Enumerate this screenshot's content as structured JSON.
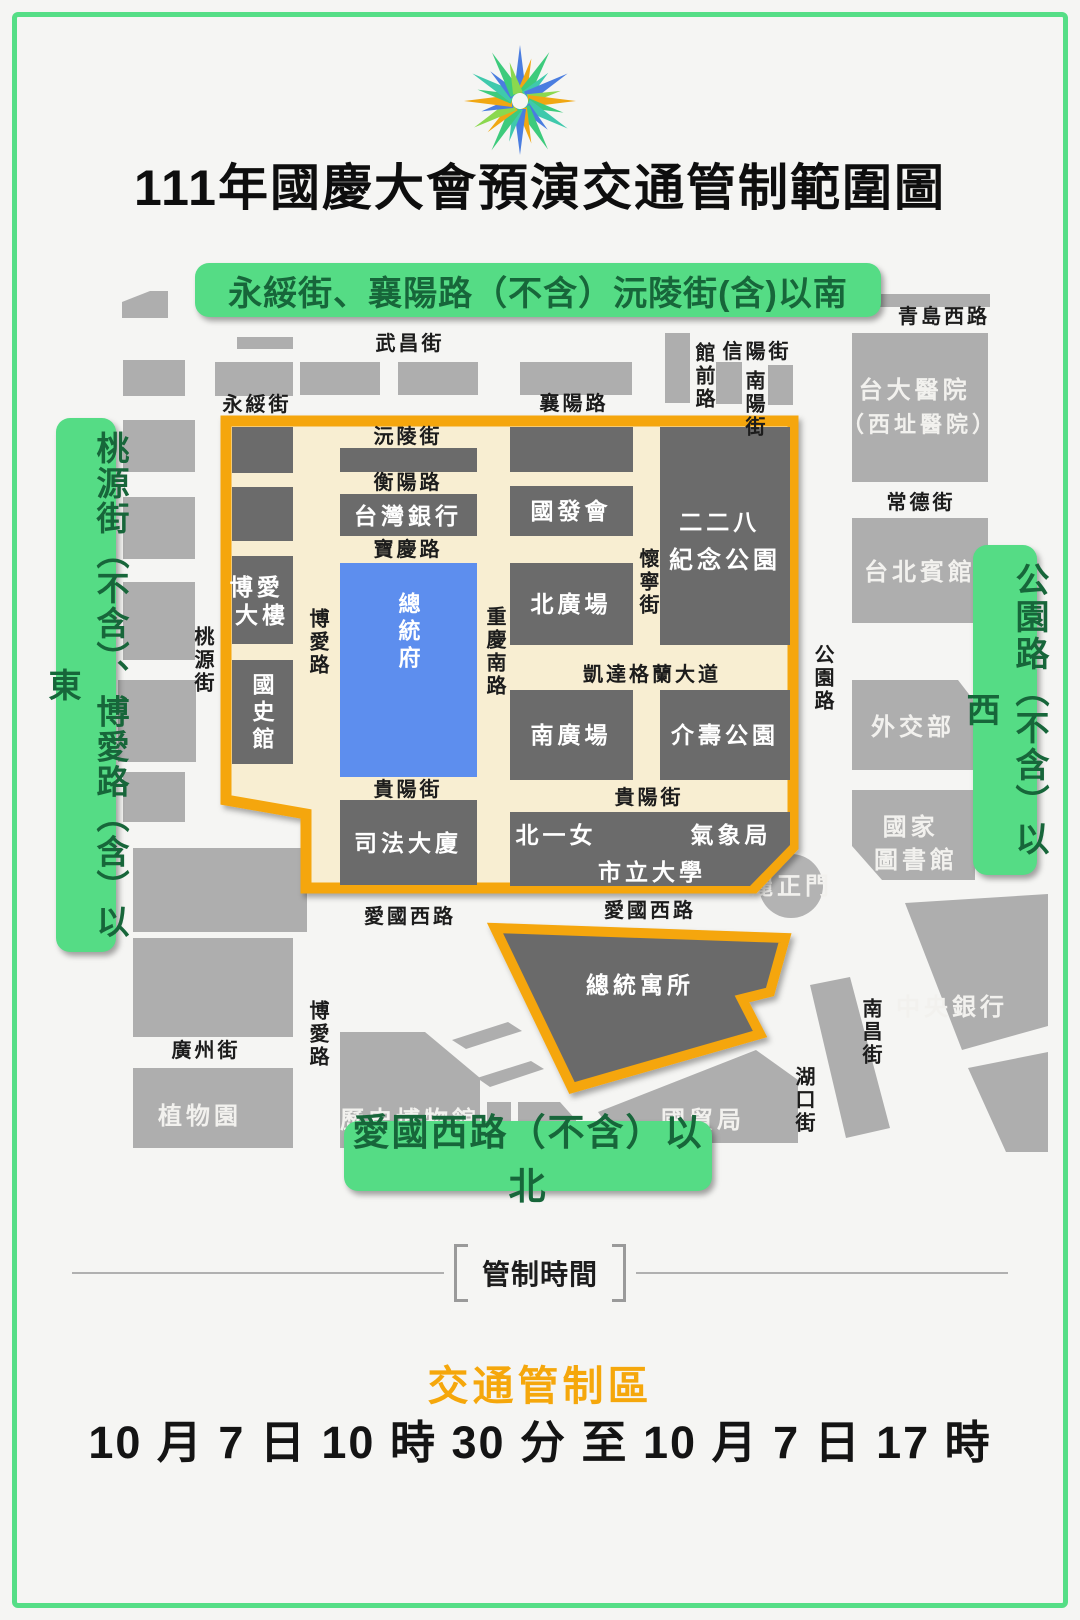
{
  "title": "111年國慶大會預演交通管制範圍圖",
  "banners": {
    "north": "永綏街、襄陽路（不含）沅陵街(含)以南",
    "west": "桃源街（不含）、博愛路（含）以東",
    "east": "公園路（不含）以西",
    "south": "愛國西路（不含）以北"
  },
  "map": {
    "streets": {
      "wuchang": "武昌街",
      "yongsui": "永綏街",
      "xiangyang": "襄陽路",
      "qingdao_w": "青島西路",
      "guanqian": "館前路",
      "xinyang": "信陽街",
      "nanyang": "南陽街",
      "changde": "常德街",
      "gongyuan": "公園路",
      "taoyuan": "桃源街",
      "yuanling": "沅陵街",
      "hengyang": "衡陽路",
      "baoqing": "寶慶路",
      "boai": "博愛路",
      "chongqing_s": "重慶南路",
      "huaining": "懷寧街",
      "ketagalan": "凱達格蘭大道",
      "guiyang": "貴陽街",
      "aiguo_xi": "愛國西路",
      "guangzhou": "廣州街",
      "nanchang": "南昌街",
      "hukou": "湖口街"
    },
    "places": {
      "ntu_hospital": "台大醫院",
      "ntu_hospital_sub": "（西址醫院）",
      "taipei_guest_house": "台北賓館",
      "mofa": "外交部",
      "ncl_line1": "國家",
      "ncl_line2": "圖書館",
      "lizhengmen": "麗正門",
      "central_bank": "中央銀行",
      "trade_bureau": "國貿局",
      "history_museum": "歷史博物館",
      "botanical_garden": "植物園",
      "bank_of_taiwan": "台灣銀行",
      "ndc": "國發會",
      "park228_line1": "二二八",
      "park228_line2": "紀念公園",
      "boai_bldg_line1": "博愛",
      "boai_bldg_line2": "大樓",
      "academia_historica": "國史館",
      "presidential_office": "總統府",
      "north_plaza": "北廣場",
      "south_plaza": "南廣場",
      "jieshou_park": "介壽公園",
      "judicial_building": "司法大廈",
      "first_girls_school": "北一女",
      "weather_bureau": "氣象局",
      "city_university": "市立大學",
      "presidential_residence": "總統寓所"
    }
  },
  "footer": {
    "section_label": "管制時間",
    "zone_label": "交通管制區",
    "time_range": "10 月 7 日 10 時 30 分 至 10 月 7 日 17 時"
  },
  "colors": {
    "frame_green": "#55de86",
    "banner_green": "#55dc85",
    "banner_text_green": "#17663a",
    "zone_border_orange": "#f5a60b",
    "zone_fill_cream": "#f8eed2",
    "building_dark_gray": "#6b6b6b",
    "building_light_gray": "#aeaeae",
    "presidential_office_blue": "#5d8eee",
    "accent_orange_text": "#f5a70b"
  }
}
